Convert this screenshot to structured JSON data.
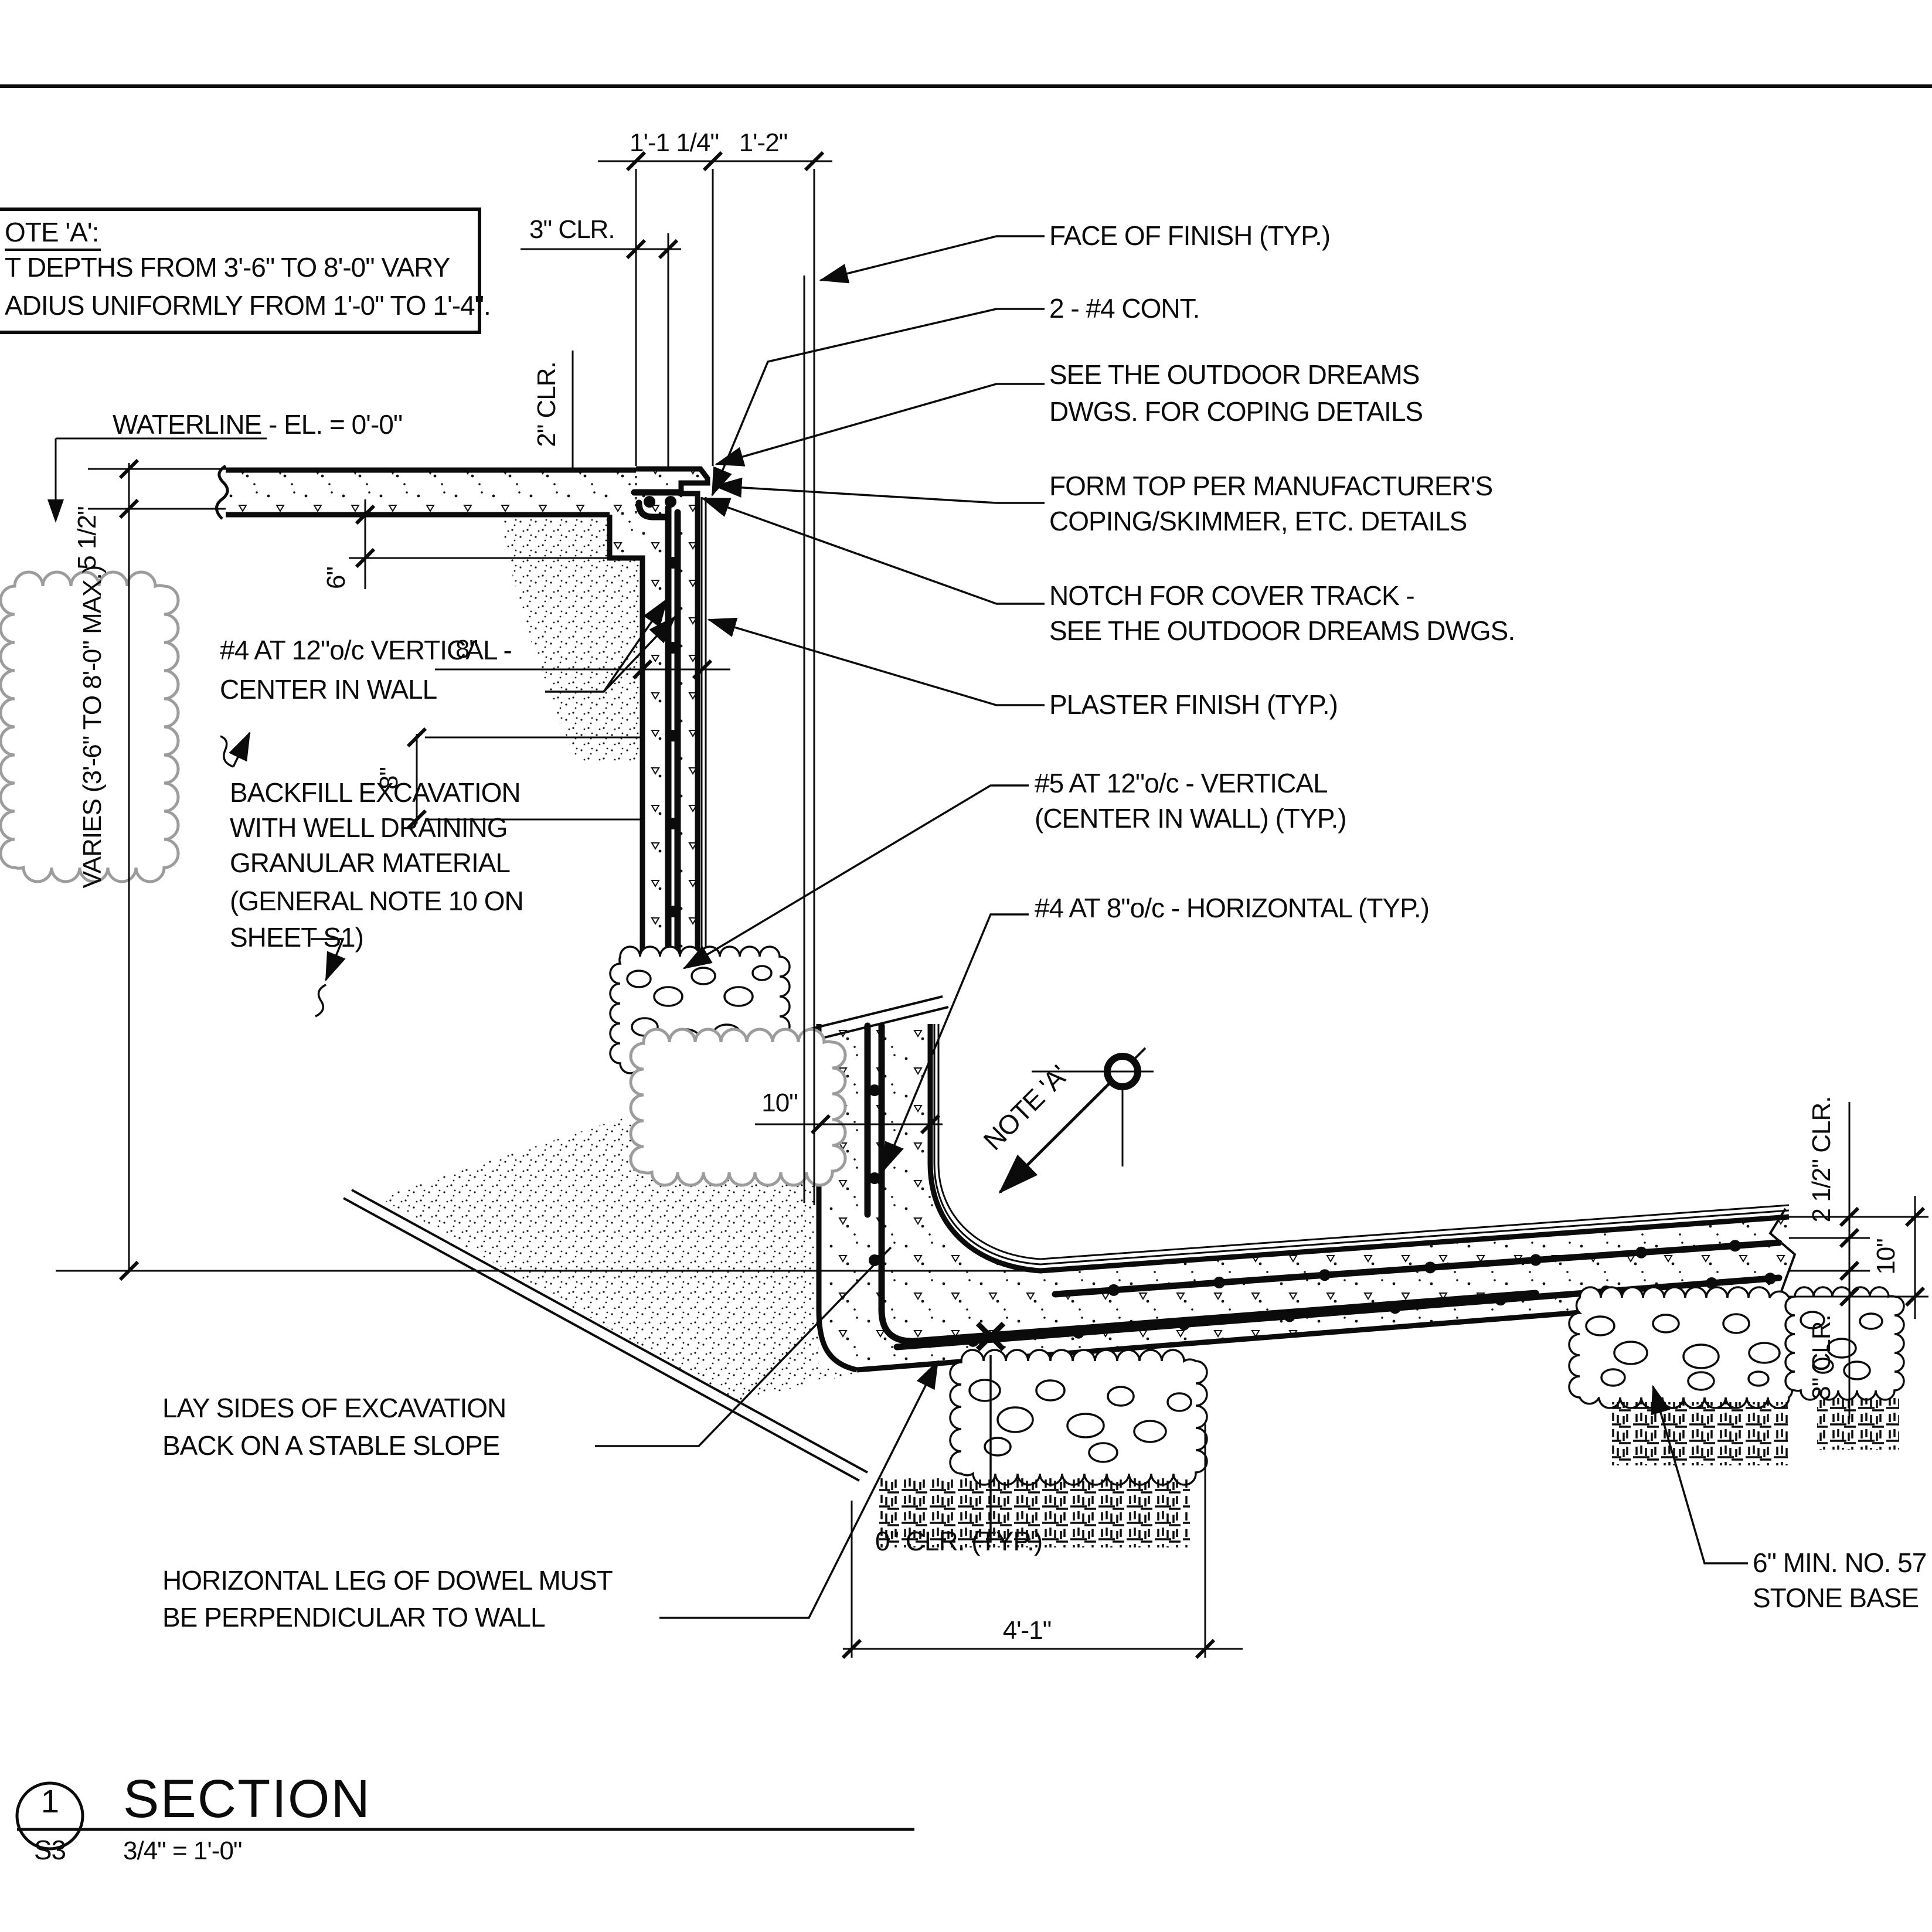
{
  "sheet": {
    "detail_number": "1",
    "sheet_ref": "S3",
    "title": "SECTION",
    "scale_label": "3/4\" = 1'-0\""
  },
  "note_box": {
    "line1": "OTE 'A':",
    "line2": "T DEPTHS FROM 3'-6\" TO 8'-0\" VARY",
    "line3": "ADIUS UNIFORMLY FROM 1'-0\" TO 1'-4\"."
  },
  "dimensions": {
    "top_left": "1'-1 1/4\"",
    "top_right": "1'-2\"",
    "clr3_top": "3\" CLR.",
    "clr2": "2\" CLR.",
    "waterline": "WATERLINE - EL. = 0'-0\"",
    "d5half": "5 1/2\"",
    "varies": "VARIES (3'-6\" TO 8'-0\" MAX.)",
    "d6": "6\"",
    "d8_horiz": "8\"",
    "d8_vert": "8\"",
    "d10_wall": "10\"",
    "clr2half": "2 1/2\" CLR.",
    "d10_slab": "10\"",
    "clr3_bottom": "3\" CLR.",
    "d41": "4'-1\"",
    "clr0": "0\" CLR. (TYP.)"
  },
  "callouts": {
    "face_of_finish": "FACE OF FINISH (TYP.)",
    "cont_bars": "2 - #4 CONT.",
    "coping_l1": "SEE THE OUTDOOR DREAMS",
    "coping_l2": "DWGS. FOR COPING DETAILS",
    "form_top_l1": "FORM TOP PER MANUFACTURER'S",
    "form_top_l2": "COPING/SKIMMER, ETC. DETAILS",
    "notch_l1": "NOTCH FOR COVER TRACK -",
    "notch_l2": "SEE THE OUTDOOR DREAMS DWGS.",
    "plaster": "PLASTER FINISH (TYP.)",
    "vert5_l1": "#5 AT 12\"o/c - VERTICAL",
    "vert5_l2": "(CENTER IN WALL) (TYP.)",
    "horiz4": "#4 AT 8\"o/c - HORIZONTAL (TYP.)",
    "vert4_l1": "#4 AT 12\"o/c VERTICAL -",
    "vert4_l2": "CENTER IN WALL",
    "backfill_l1": "BACKFILL EXCAVATION",
    "backfill_l2": "WITH  WELL DRAINING",
    "backfill_l3": "GRANULAR MATERIAL",
    "backfill_l4": "(GENERAL NOTE 10 ON",
    "backfill_l5": "SHEET S1)",
    "lay_l1": "LAY SIDES OF EXCAVATION",
    "lay_l2": "BACK ON A STABLE SLOPE",
    "dowel_l1": "HORIZONTAL LEG OF DOWEL MUST",
    "dowel_l2": "BE PERPENDICULAR TO WALL",
    "stone_l1": "6\" MIN. NO. 57",
    "stone_l2": "STONE BASE",
    "note_a": "NOTE 'A'"
  }
}
